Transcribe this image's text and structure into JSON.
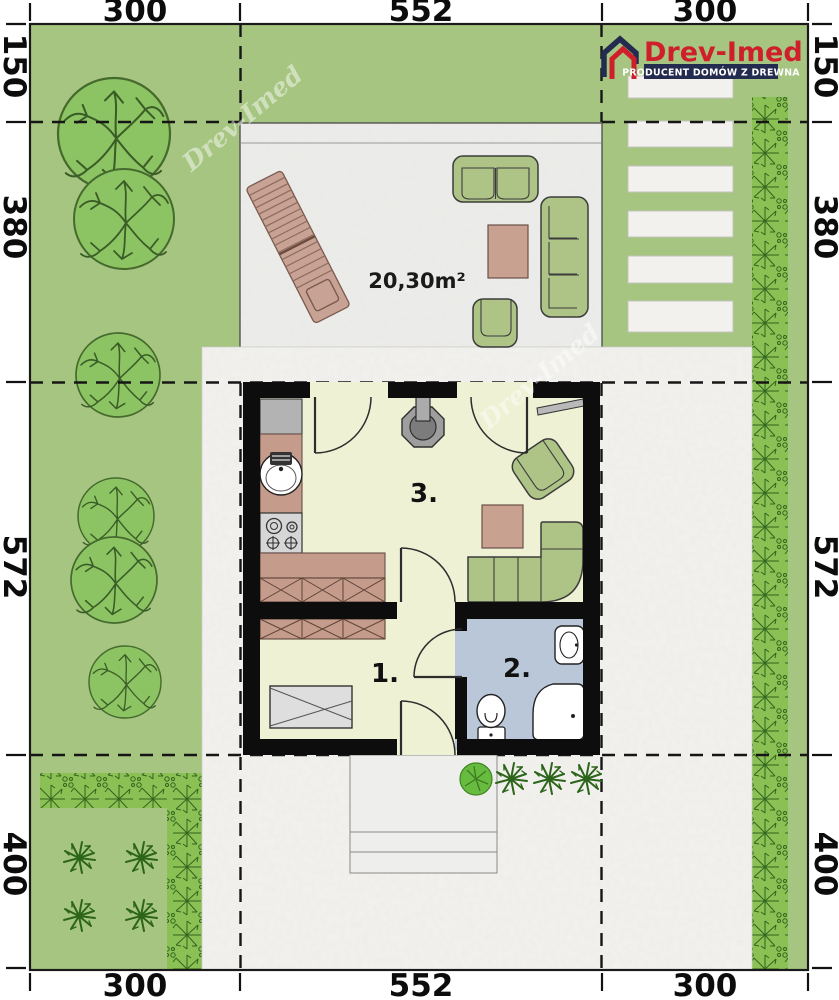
{
  "logo": {
    "brand": "Drev-Imed",
    "tagline": "PRODUCENT DOMÓW Z DREWNA",
    "brand_color": "#cf1f2b",
    "tagline_bar_color": "#232c4e"
  },
  "watermark": {
    "text": "Drev-Imed"
  },
  "dimensions": {
    "top": [
      "300",
      "552",
      "300"
    ],
    "bottom": [
      "300",
      "552",
      "300"
    ],
    "left": [
      "150",
      "380",
      "572",
      "400"
    ],
    "right": [
      "150",
      "380",
      "572",
      "400"
    ]
  },
  "plan": {
    "terrace_area_label": "20,30m²",
    "room_labels": {
      "bedroom": "1.",
      "bathroom": "2.",
      "living_kitchen": "3."
    }
  },
  "colors": {
    "lawn": "#a6c581",
    "hedge": "#8bc154",
    "tree": "#8cc363",
    "paving": "#f3f2ef",
    "terrace": "#ececea",
    "room_floor": "#eef1d3",
    "bath_floor": "#b9c7d9",
    "wall": "#0d0d0d",
    "furniture_green": "#aec487",
    "counter_brown": "#c59b8c",
    "table_brown": "#c9a191",
    "sunbed_tan": "#c8a294",
    "bed_gray": "#dedede"
  }
}
